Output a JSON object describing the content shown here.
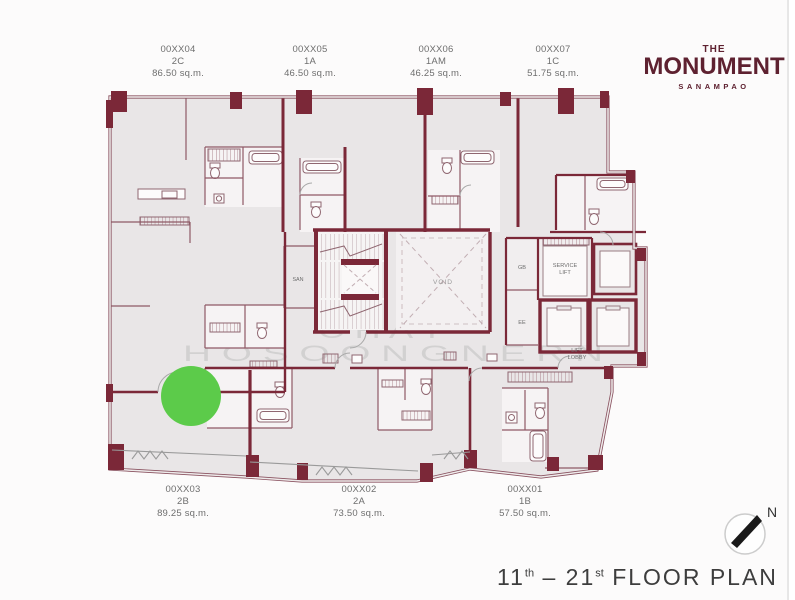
{
  "brand": {
    "the": "THE",
    "name": "MONUMENT",
    "subtitle": "SANAMPAO"
  },
  "plan_title": {
    "start_num": "11",
    "start_sup": "th",
    "separator": " – ",
    "end_num": "21",
    "end_sup": "st",
    "suffix": " FLOOR PLAN"
  },
  "units_top": [
    {
      "id": "00XX04",
      "type": "2C",
      "area": "86.50 sq.m."
    },
    {
      "id": "00XX05",
      "type": "1A",
      "area": "46.50 sq.m."
    },
    {
      "id": "00XX06",
      "type": "1AM",
      "area": "46.25 sq.m."
    },
    {
      "id": "00XX07",
      "type": "1C",
      "area": "51.75 sq.m."
    }
  ],
  "units_bottom": [
    {
      "id": "00XX03",
      "type": "2B",
      "area": "89.25 sq.m."
    },
    {
      "id": "00XX02",
      "type": "2A",
      "area": "73.50 sq.m."
    },
    {
      "id": "00XX01",
      "type": "1B",
      "area": "57.50 sq.m."
    }
  ],
  "core_labels": {
    "san": "SAN",
    "void": "VOID",
    "gb": "GB",
    "ee": "EE",
    "service_lift_line1": "SERVICE",
    "service_lift_line2": "LIFT",
    "lift_lobby_line1": "LIFT",
    "lift_lobby_line2": "LOBBY"
  },
  "watermark": {
    "line1": "C H A T",
    "line2": "H O S O O N G N E R N"
  },
  "compass": {
    "label": "N"
  },
  "marker": {
    "color": "#5ccb4a"
  },
  "colors": {
    "wall": "#7b2838",
    "floor": "#e9e6e7",
    "brand": "#5e2130"
  }
}
